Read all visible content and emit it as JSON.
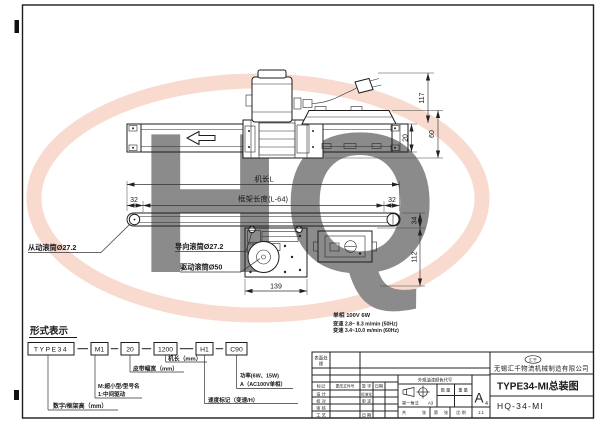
{
  "watermark": {
    "text": "HQ"
  },
  "views": {
    "top": {
      "dim_117": "117",
      "dim_20": "20",
      "dim_60": "60"
    },
    "side": {
      "dim_machine_length": "机长L",
      "dim_frame_length": "框架长度(L-64)",
      "dim_32_left": "32",
      "dim_32_right": "32",
      "dim_34": "34",
      "dim_112": "112",
      "dim_139": "139",
      "label_driven_roller": "从动滚筒Ø27.2",
      "label_guide_roller": "导向滚筒Ø27.2",
      "label_drive_roller": "驱动滚筒Ø50"
    }
  },
  "specs": {
    "power": "单相 100V 6W",
    "speed_50hz": "变速 2.8~ 8.3 m/min (50Hz)",
    "speed_60hz": "变速 3.4~10.0 m/min (60Hz)"
  },
  "model_code": {
    "title": "形式表示",
    "segments": [
      "TYPE34",
      "M1",
      "20",
      "1200",
      "H1",
      "C90"
    ],
    "callout_frame_height": "数字/框架高（mm）",
    "callout_model_line1": "M:超小型/型号名",
    "callout_model_line2": "1:中间驱动",
    "callout_belt_width": "皮带幅宽（mm）",
    "callout_machine_length": "机长（mm）",
    "callout_speed": "速度标记（变速/H）",
    "callout_power_line1": "功率(6W、15W)",
    "callout_power_line2": "A（AC100V单相）"
  },
  "title_block": {
    "logo": "汇千",
    "company": "无锡汇千物流机械制造有限公司",
    "drawing_title": "TYPE34-MI总装图",
    "drawing_no": "HQ-34-MI",
    "paper_size": "A",
    "paper_size_sub": "4",
    "surface_line1": "表面处",
    "surface_line2": "理",
    "header_mark": "标记",
    "header_change_no": "更改文件号",
    "header_sign": "签 字",
    "header_date": "日期",
    "row_design": "设 计",
    "row_check": "校 对",
    "row_review": "审 核",
    "row_process": "工 艺",
    "row_standard": "标准化",
    "row_approve": "审 定",
    "row_date": "日 期",
    "paint_code": "外观油漆颜色代号",
    "projection": "第一角法",
    "projection_size": "A3",
    "qty": "数 量",
    "weight": "重 量",
    "sheet_total": "共",
    "sheet_unit": "张",
    "sheet_no": "第",
    "sheet_unit2": "张",
    "scale_label": "比 例",
    "scale_value": "1:1"
  }
}
